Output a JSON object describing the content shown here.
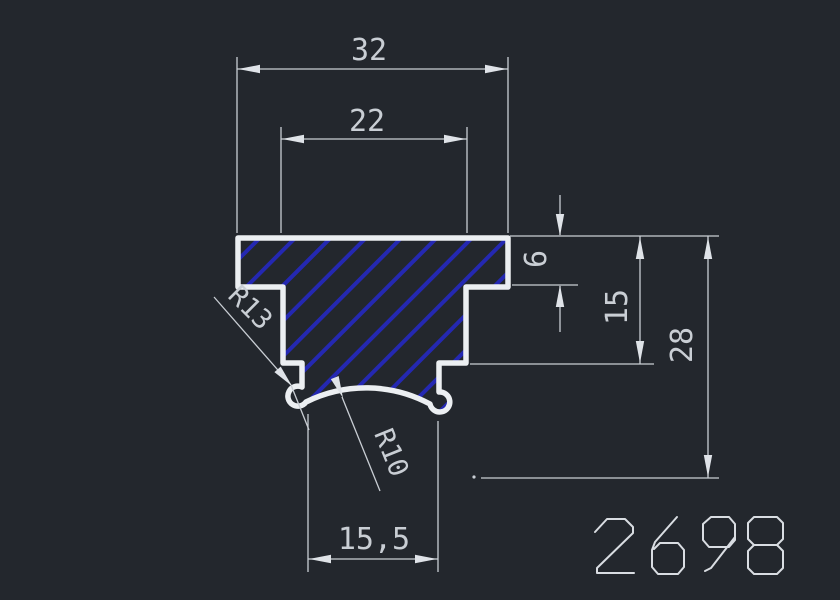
{
  "drawing": {
    "part_number": "2698",
    "dimensions": {
      "top_width": "32",
      "inner_width": "22",
      "flange_height": "6",
      "step_depth": "15",
      "total_height": "28",
      "bottom_width": "15,5",
      "radius_left": "R13",
      "radius_bottom": "R10"
    },
    "colors": {
      "background": "#23272d",
      "profile_outline": "#eceff2",
      "hatch_blue": "#2428b2",
      "dimension_gray": "#c9ced4"
    }
  }
}
